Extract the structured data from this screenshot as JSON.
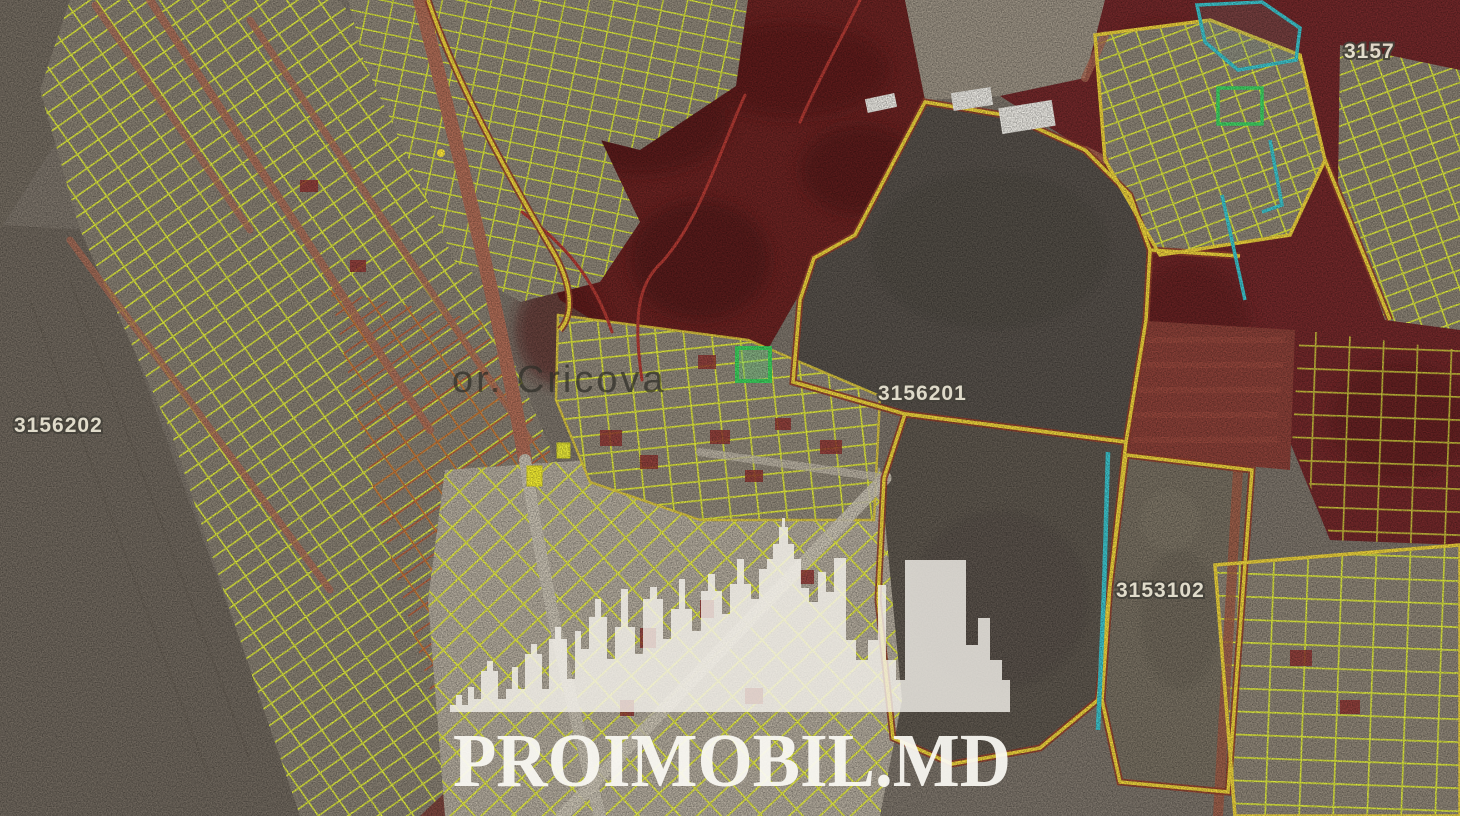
{
  "page": {
    "title": "Satellite cadastral map of or. Cricova with parcel overlay"
  },
  "map": {
    "town_label": "or. Cricova",
    "cadastral_labels": [
      {
        "id": "left-sector",
        "text": "3156202"
      },
      {
        "id": "center-sector",
        "text": "3156201"
      },
      {
        "id": "south-sector",
        "text": "3153102"
      },
      {
        "id": "north-east-sector",
        "text": "3157"
      }
    ],
    "highlighted_parcel": {
      "description": "green highlighted land plot near or. Cricova",
      "color": "#3ed05e"
    },
    "colors": {
      "parcel_line_yellow": "#dce73f",
      "boundary_yellow": "#e9cf3b",
      "boundary_red_underlay": "#93402c",
      "road_salmon": "#ad6b55",
      "overlay_maroon": "#6e2424",
      "forest_maroon": "#5a1c1a",
      "field_dark_gray": "#57514a",
      "field_light_gray": "#7a7164",
      "town_ground": "#b3ab9d",
      "teal_line": "#3cc3cb",
      "red_parcel_fill": "#8f3431"
    }
  },
  "watermark": {
    "text": "PROIMOBIL.MD",
    "logo": "city-skyline-silhouette"
  }
}
